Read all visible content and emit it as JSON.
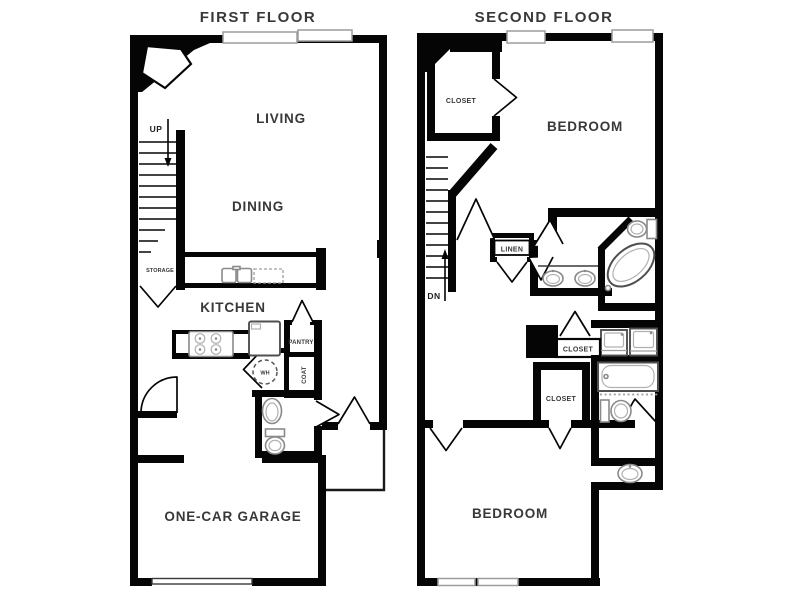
{
  "colors": {
    "wall": "#050505",
    "text": "#383838",
    "fixture": "#8a8a8a",
    "fixture_dark": "#4f4f4f",
    "window_border": "#9c9c9c"
  },
  "first_floor": {
    "title": "FIRST FLOOR",
    "living": "LIVING",
    "dining": "DINING",
    "kitchen": "KITCHEN",
    "garage": "ONE-CAR GARAGE",
    "up": "UP",
    "storage": "STORAGE",
    "pantry": "PANTRY",
    "coat": "COAT",
    "water_heater": "WH"
  },
  "second_floor": {
    "title": "SECOND FLOOR",
    "bedroom_master": "BEDROOM",
    "bedroom_second": "BEDROOM",
    "closet_master": "CLOSET",
    "linen": "LINEN",
    "down": "DN",
    "closet_hall": "CLOSET",
    "closet_second": "CLOSET"
  }
}
